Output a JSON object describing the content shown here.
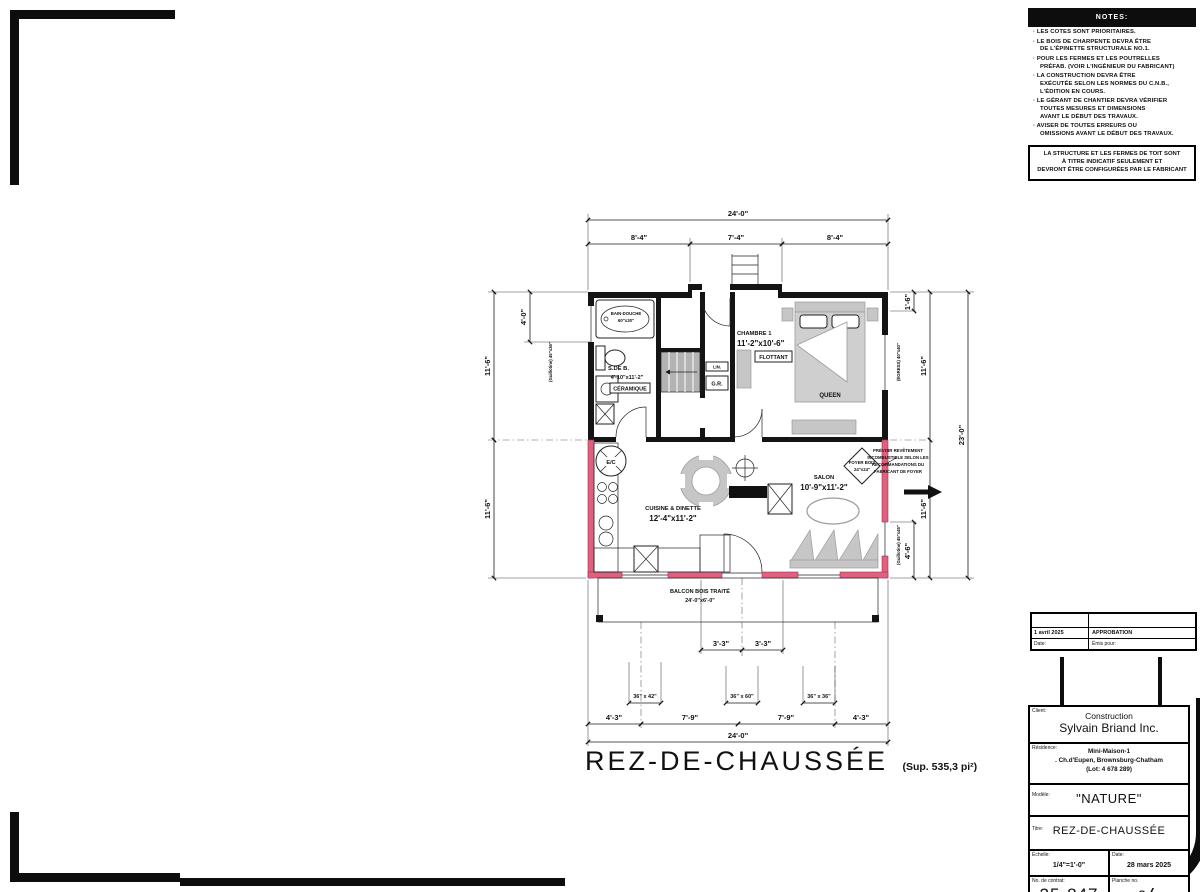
{
  "notes": {
    "header": "NOTES:",
    "items": [
      "LES COTES SONT PRIORITAIRES.",
      "LE BOIS DE CHARPENTE DEVRA ÊTRE\nDE L'ÉPINETTE STRUCTURALE NO.1.",
      "POUR LES FERMES ET LES POUTRELLES\nPRÉFAB. (VOIR L'INGÉNIEUR DU FABRICANT)",
      "LA CONSTRUCTION DEVRA ÊTRE\nEXÉCUTÉE SELON LES NORMES DU C.N.B.,\nL'ÉDITION EN COURS.",
      "LE GÉRANT DE CHANTIER DEVRA VÉRIFIER\nTOUTES MESURES ET DIMENSIONS\nAVANT LE DÉBUT DES TRAVAUX.",
      "AVISER DE TOUTES ERREURS OU\nOMISSIONS AVANT LE DÉBUT DES TRAVAUX."
    ],
    "boxed_note": "LA STRUCTURE ET LES FERMES DE TOIT SONT\nÀ TITRE INDICATIF SEULEMENT ET\nDEVRONT ÊTRE CONFIGURÉES PAR LE FABRICANT"
  },
  "revisions": {
    "rows": [
      {
        "date": "1 avril 2025",
        "purpose": "APPROBATION"
      }
    ],
    "date_label": "Date:",
    "purpose_label": "Émis pour:"
  },
  "title_block": {
    "client_label": "Client:",
    "client_name_line1": "Construction",
    "client_name_line2": "Sylvain Briand Inc.",
    "residence_label": "Résidence:",
    "residence_line1": "Mini-Maison-1",
    "residence_line2": ". Ch.d'Eupen, Brownsburg-Chatham",
    "residence_line3": "(Lot: 4 678 289)",
    "model_label": "Modèle:",
    "model_value": "\"NATURE\"",
    "sheet_title_label": "Titre:",
    "sheet_title": "REZ-DE-CHAUSSÉE",
    "scale_label": "Échelle:",
    "scale_value": "1/4\"=1'-0\"",
    "date_label": "Date:",
    "date_value": "28 mars 2025",
    "contract_label": "No. de contrat:",
    "contract_value": "25-847",
    "sheet_no_label": "Planche no.",
    "sheet_no": "3",
    "sheet_sep": "/",
    "sheet_total": "3"
  },
  "plan": {
    "title": "REZ-DE-CHAUSSÉE",
    "area": "(Sup. 535,3 pi²)",
    "rooms": {
      "bath_name": "S.DE B.",
      "bath_dims": "4'-10\"x11'-2\"",
      "bath_floor": "CÉRAMIQUE",
      "bedroom_name": "CHAMBRE 1",
      "bedroom_dims": "11'-2\"x10'-6\"",
      "bedroom_floor": "FLOTTANT",
      "bed_label": "QUEEN",
      "kitchen_name": "CUISINE & DINETTE",
      "kitchen_dims": "12'-4\"x11'-2\"",
      "living_name": "SALON",
      "living_dims": "10'-9\"x11'-2\"",
      "entry_floor": "CÉRAMIQUE",
      "closet": "G.R.",
      "linen": "LIN.",
      "water_heater": "E/C",
      "tub_line1": "BAIN-DOUCHE",
      "tub_line2": "60\"x30\""
    },
    "foyer": {
      "line1": "FOYER BOIS",
      "line2": "24\"x24\""
    },
    "foyer_note_lines": [
      "PRÉVOIR REVÊTEMENT",
      "INCOMBUSTIBLE SELON LES",
      "RECOMMANDATIONS DU",
      "FABRICANT DE FOYER"
    ],
    "balcony_line1": "BALCON BOIS TRAITÉ",
    "balcony_line2": "24'-0\"x6'-0\"",
    "dims": {
      "top_total": "24'-0\"",
      "top_a": "8'-4\"",
      "top_b": "7'-4\"",
      "top_c": "8'-4\"",
      "left_top": "11'-6\"",
      "left_bottom": "11'-6\"",
      "left_sub": "4'-0\"",
      "right_total": "23'-0\"",
      "right_top": "11'-6\"",
      "right_bottom": "11'-6\"",
      "right_sub_top": "1'-6\"",
      "right_sub_bottom": "4'-6\"",
      "door_left": "3'-3\"",
      "door_right": "3'-3\"",
      "bottom_a": "4'-3\"",
      "bottom_b": "7'-9\"",
      "bottom_c": "7'-9\"",
      "bottom_d": "4'-3\"",
      "bottom_total": "24'-0\"",
      "win_bottom_left": "36\" x 42\"",
      "win_bottom_mid": "36\" x 60\"",
      "win_bottom_right": "36\" x 36\"",
      "win_left_label": "(Guillotine) 45\"x36\"",
      "win_right_top_label": "(ÉGRESS) 40\"x40\"",
      "win_right_bottom_label": "(Guillotine) 45\"x45\""
    }
  }
}
